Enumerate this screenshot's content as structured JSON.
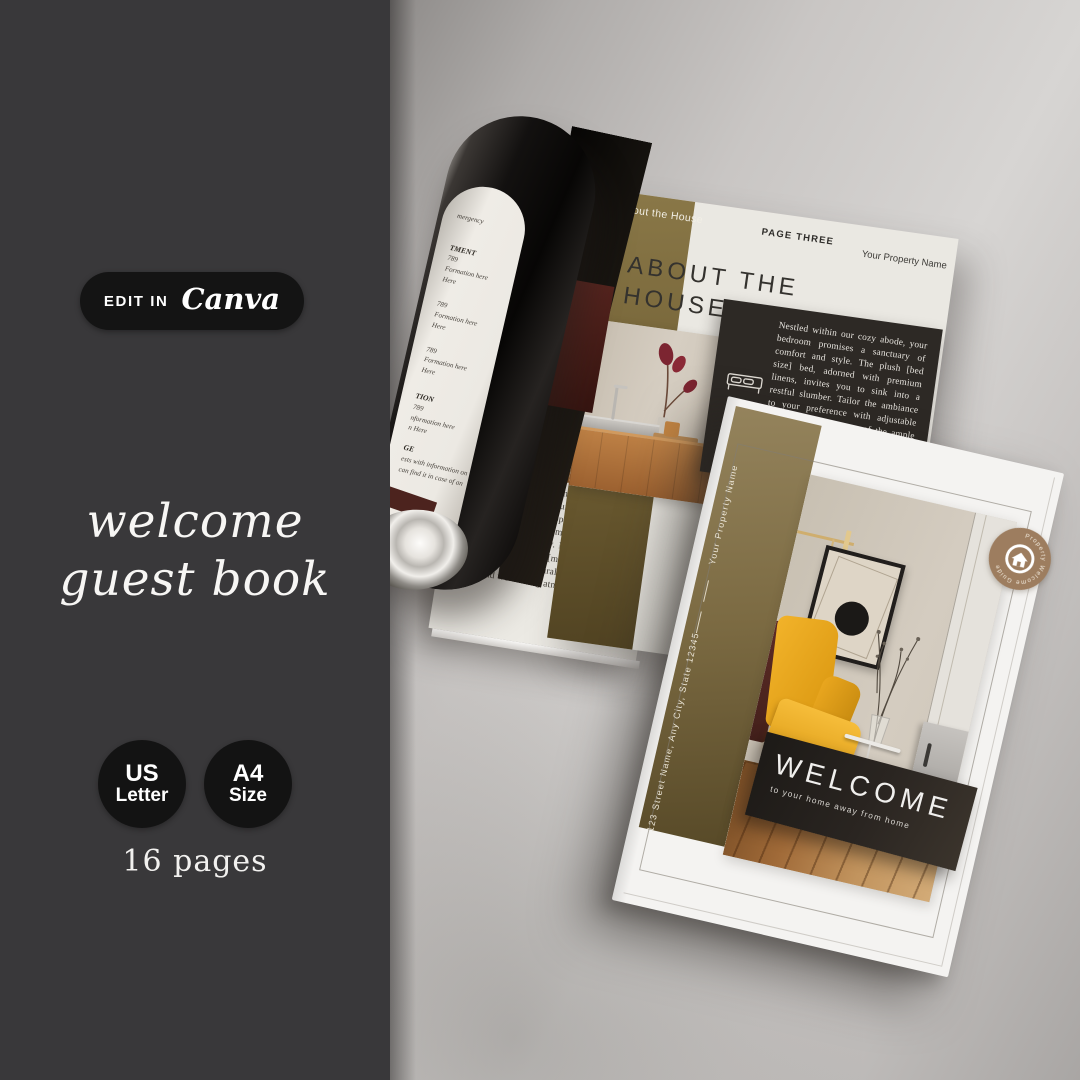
{
  "sidebar": {
    "edit_badge": {
      "prefix": "EDIT IN",
      "brand": "Canva"
    },
    "title_line1": "welcome",
    "title_line2": "guest book",
    "size_badges": [
      {
        "line1": "US",
        "line2": "Letter"
      },
      {
        "line1": "A4",
        "line2": "Size"
      }
    ],
    "page_count": "16 pages"
  },
  "spread": {
    "curl_lines": [
      "mergency",
      "TMENT",
      "789",
      "Formation here",
      "Here",
      "789",
      "Formation here",
      "Here",
      "789",
      "Formation here",
      "Here",
      "TION",
      "789",
      "nformation here",
      "n Here",
      "GE",
      "ests with information on",
      "can find it in case of an"
    ],
    "left_page_body": "[Provide guests with the details about your house here]. Our [number of bedrooms] bedroom [type of property] is designed to provide you with a comfortable and inviting space during your stay. Nestled in [location], this home boasts [mention any unique features or architectural details], creating a warm and welcoming atmosphere.",
    "right_page": {
      "band_label": "About the House",
      "page_label": "PAGE THREE",
      "property_name": "Your Property Name",
      "title_line1": "ABOUT THE",
      "title_line2": "HOUSE",
      "body": "Nestled within our cozy abode, your bedroom promises a sanctuary of comfort and style. The plush [bed size] bed, adorned with premium linens, invites you to sink into a restful slumber. Tailor the ambiance to your preference with adjustable lighting, and make use of the ample storage in the wardrobe and dresser for a seamless unpacking."
    }
  },
  "cover": {
    "property_name": "Your Property Name",
    "address": "123 Street Name, Any City, State 12345",
    "welcome": "WELCOME",
    "tagline": "to your home away from home",
    "badge_text": "Property Welcome Guide"
  },
  "colors": {
    "sidebar_bg": "#39383a",
    "pill_bg": "#141414",
    "olive_band": "#7b6a42",
    "dark_panel": "#2d2925",
    "maroon_accent": "#4e231e",
    "chair_yellow": "#e9a81d",
    "badge_brown": "#9d7d5f"
  }
}
